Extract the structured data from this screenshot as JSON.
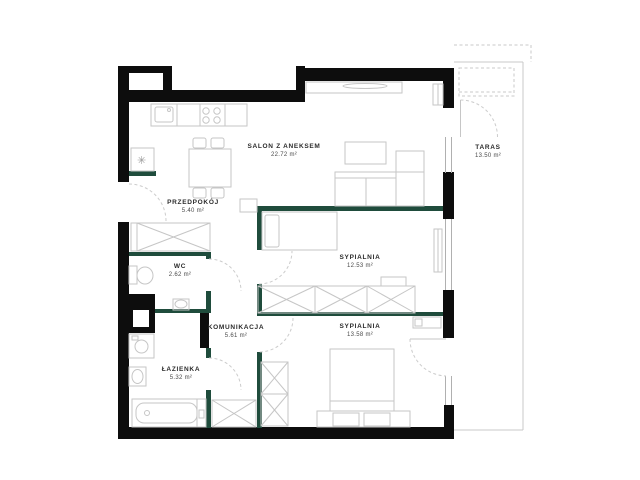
{
  "rooms": [
    {
      "id": "salon",
      "name": "SALON Z ANEKSEM",
      "area": "22.72 m²"
    },
    {
      "id": "przedpokoj",
      "name": "PRZEDPOKÓJ",
      "area": "5.40 m²"
    },
    {
      "id": "wc",
      "name": "WC",
      "area": "2.62 m²"
    },
    {
      "id": "komunikacja",
      "name": "KOMUNIKACJA",
      "area": "5.61 m²"
    },
    {
      "id": "lazienka",
      "name": "ŁAZIENKA",
      "area": "5.32 m²"
    },
    {
      "id": "sypialnia_1",
      "name": "SYPIALNIA",
      "area": "12.53 m²"
    },
    {
      "id": "sypialnia_2",
      "name": "SYPIALNIA",
      "area": "13.58 m²"
    },
    {
      "id": "taras",
      "name": "TARAS",
      "area": "13.50 m²"
    }
  ],
  "symbols": {
    "fridge_asterisk": "✳"
  },
  "colors": {
    "exterior_wall": "#0d0d0d",
    "partition_wall_green": "#1f4c3c",
    "furniture_line": "#c6c6c6",
    "label_text": "#2b2b2b",
    "background": "#ffffff"
  }
}
